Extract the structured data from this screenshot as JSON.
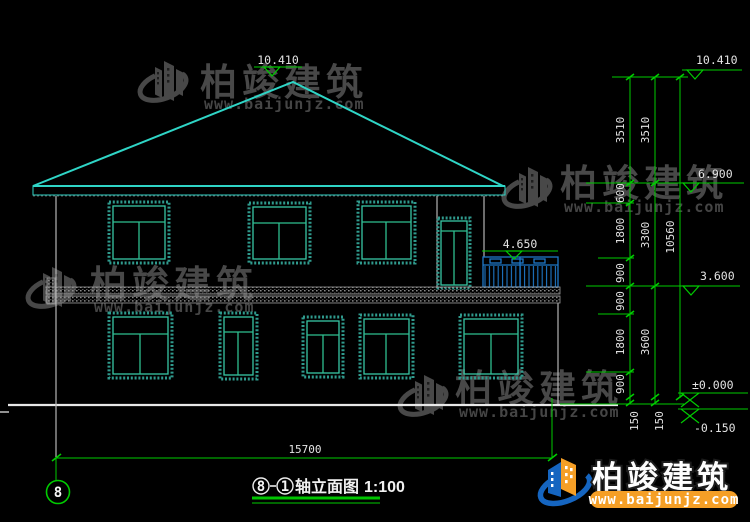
{
  "watermark": {
    "brand": "柏竣建筑",
    "site": "www.baijunjz.com"
  },
  "brand_logo": {
    "brand": "柏竣建筑",
    "site": "www.baijunjz.com"
  },
  "elevations": {
    "peak": "10.410",
    "right_peak": "10.410",
    "eave": "6.900",
    "balcony": "4.650",
    "second_floor": "3.600",
    "ground": "±0.000",
    "outdoor": "-0.150"
  },
  "dimensions": {
    "bottom_total": "15700",
    "overall_height": "10560",
    "inner_chain": [
      "3510",
      "600",
      "1800",
      "900",
      "900",
      "1800",
      "900"
    ],
    "middle_chain": [
      "3510",
      "3300",
      "3600"
    ],
    "base_offsets": [
      "150",
      "150"
    ]
  },
  "axis": {
    "left_bubble": "8"
  },
  "title": {
    "axis_a": "8",
    "axis_b": "1",
    "name": "轴立面图",
    "scale": "1:100"
  }
}
